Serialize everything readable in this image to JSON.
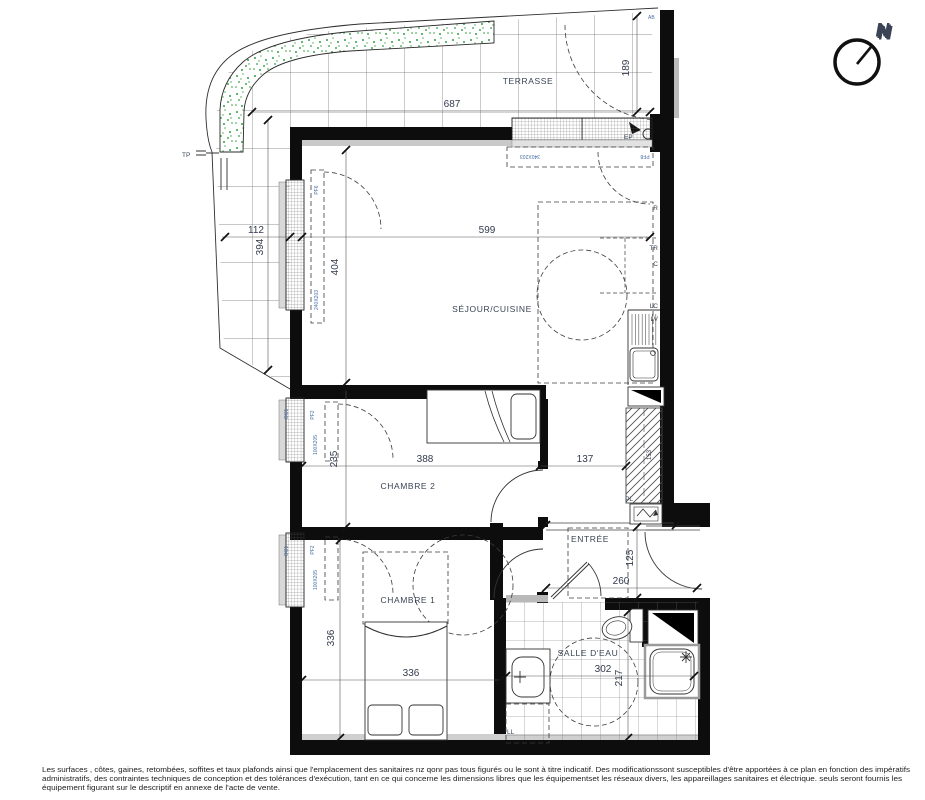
{
  "compass": {
    "n": "N"
  },
  "labels": {
    "terrasse": "TERRASSE",
    "sejour": "SÉJOUR/CUISINE",
    "chambre1": "CHAMBRE 1",
    "chambre2": "CHAMBRE 2",
    "entree": "ENTRÉE",
    "salle_eau": "SALLE D'EAU",
    "tp": "TP",
    "ep": "EP",
    "pl": "PL",
    "ll": "LL",
    "ab": "AB"
  },
  "kitchen": {
    "labels": {
      "r": "R",
      "tr": "TR",
      "c": "C",
      "lc": "LC",
      "lv": "LV"
    }
  },
  "dims": {
    "terrace_w": "687",
    "terrace_d": "189",
    "terrace_strip_w": "112",
    "terrace_strip_h": "394",
    "sejour_w": "599",
    "sejour_h": "404",
    "chambre2_w": "388",
    "chambre2_h": "235",
    "hall_w": "137",
    "chambre1_w": "336",
    "chambre1_h": "336",
    "entree_w": "260",
    "entree_h": "125",
    "salle_eau_w": "302",
    "salle_eau_h": "217",
    "shaft": "153"
  },
  "windows": {
    "sejour_ref": "PF6",
    "sejour_size": "240X203",
    "bay_size": "340X203",
    "bay_ref": "PF8",
    "bedroom_ref": "PF2",
    "bedroom_size": "100X205",
    "shutter_ref": "OC1"
  },
  "footer": {
    "line1": "Les surfaces , côtes, gaines, retombées, soffites et taux plafonds ainsi que l'emplacement des sanitaires nz qonr pas tous figurés ou le sont à titre indicatif. Des modificationssont susceptibles d'être apportées à ce plan en fonction des impératifs",
    "line2": "administratifs, des contraintes techniques de conception et des tolérances d'exécution, tant en ce qui concerne les dimensions libres que les équipementset les réseaux divers, les appareillages sanitaires et électrique. seuls seront fournis les",
    "line3": "équipement figurant sur le descriptif en annexe de l'acte de vente."
  },
  "colors": {
    "wall": "#0d0d0d",
    "planter_green": "#2f9e44",
    "annotation_blue": "#4a6fa5",
    "dim_text": "#333a4d"
  }
}
